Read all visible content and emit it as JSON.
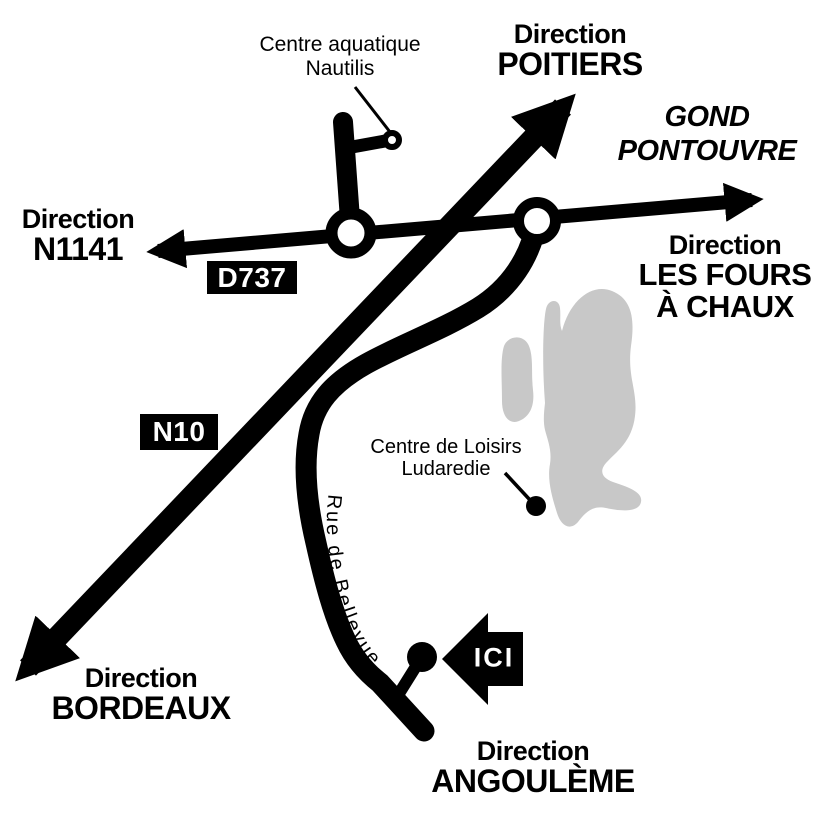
{
  "colors": {
    "road": "#000000",
    "area": "#c8c8c8",
    "background": "#ffffff",
    "badge_background": "#000000",
    "badge_text": "#ffffff"
  },
  "directions": {
    "poitiers": {
      "prefix": "Direction",
      "name": "POITIERS"
    },
    "n1141": {
      "prefix": "Direction",
      "name": "N1141"
    },
    "les_fours_a_chaux": {
      "prefix": "Direction",
      "name_line1": "LES FOURS",
      "name_line2": "À CHAUX"
    },
    "bordeaux": {
      "prefix": "Direction",
      "name": "BORDEAUX"
    },
    "angouleme": {
      "prefix": "Direction",
      "name": "ANGOULÈME"
    }
  },
  "places": {
    "gond_pontouvre": {
      "line1": "GOND",
      "line2": "PONTOUVRE"
    },
    "centre_aquatique": {
      "line1": "Centre aquatique",
      "line2": "Nautilis"
    },
    "centre_loisirs": {
      "line1": "Centre de Loisirs",
      "line2": "Ludaredie"
    }
  },
  "roads": {
    "d737": "D737",
    "n10": "N10",
    "rue_de_bellevue": "Rue de Bellevue"
  },
  "here_marker": {
    "label": "ICI"
  }
}
